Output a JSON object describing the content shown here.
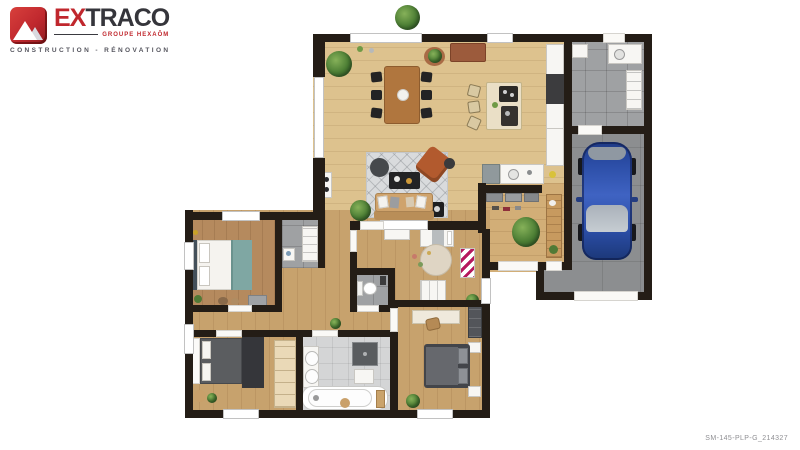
{
  "brand": {
    "icon": "mountain-logo-icon",
    "wordmark_primary": "EX",
    "wordmark_secondary": "TRACO",
    "group_label": "GROUPE HEXAÔM",
    "tagline": "CONSTRUCTION - RÉNOVATION"
  },
  "footer": {
    "reference": "SM-145-PLP-G_214327"
  },
  "floorplan": {
    "type": "3d-rendered top-down house plan",
    "rooms": [
      "living-dining-kitchen",
      "utility-room",
      "garage",
      "entry-hall",
      "master-bedroom",
      "dressing",
      "child-bedroom",
      "wc",
      "corridor",
      "bedroom-2",
      "bathroom",
      "bedroom-3"
    ],
    "key_objects": [
      "dining-table-6-chairs",
      "kitchen-island-3-stools",
      "kitchen-counters",
      "sofa",
      "rug",
      "coffee-table",
      "armchair",
      "pouf",
      "plants",
      "blue-car",
      "washing-machine",
      "coat-rack",
      "entry-bench",
      "double-bed-master",
      "bed-bench",
      "wardrobes",
      "child-bed",
      "round-rug",
      "toilet",
      "double-vanity",
      "shower",
      "bathtub",
      "double-bed-gray",
      "desk-with-chair"
    ],
    "colors": {
      "wall": "#241d16",
      "wood_light": "#ddc28e",
      "wood_wing": "#c7a26d",
      "tile_gray": "#9fa1a3",
      "concrete": "#8c8e90",
      "car_blue": "#2b4da6",
      "brand_red": "#c0272d",
      "brand_dark": "#35353b"
    }
  }
}
